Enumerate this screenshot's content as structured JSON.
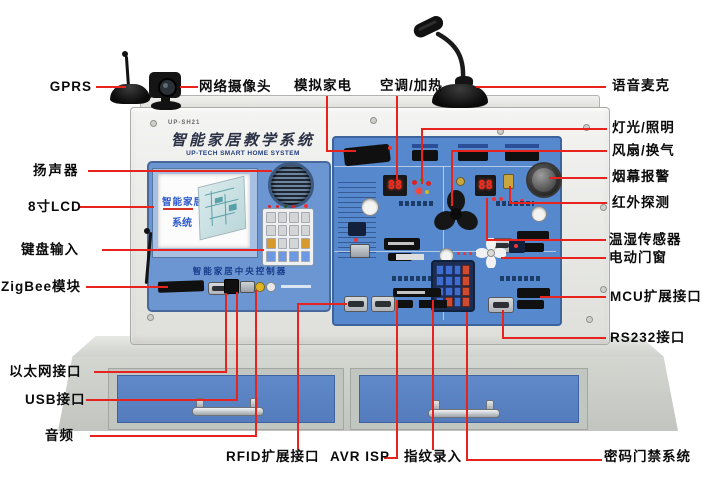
{
  "device": {
    "model": "UP-SH21",
    "title": "智能家居教学系统",
    "subtitle": "UP-TECH SMART HOME SYSTEM",
    "lcd_line1": "智能家居",
    "lcd_line2": "系统",
    "panel_caption": "智能家居中央控制器",
    "display_ac": "88",
    "display_temp": "88"
  },
  "colors": {
    "callout_red": "#e8231d",
    "panel_blue": "#5688cd",
    "drawer_blue": "#5c83c5"
  },
  "callouts": {
    "gprs": {
      "label": "GPRS"
    },
    "camera": {
      "label": "网络摄像头"
    },
    "speaker": {
      "label": "扬声器"
    },
    "lcd8": {
      "label": "8寸LCD"
    },
    "keypad": {
      "label": "键盘输入"
    },
    "zigbee": {
      "label": "ZigBee模块"
    },
    "ethernet": {
      "label": "以太网接口"
    },
    "usb": {
      "label": "USB接口"
    },
    "audio": {
      "label": "音频"
    },
    "sim_appliance": {
      "label": "模拟家电"
    },
    "ac_heat": {
      "label": "空调/加热"
    },
    "voice_mic": {
      "label": "语音麦克"
    },
    "light": {
      "label": "灯光/照明"
    },
    "fan_vent": {
      "label": "风扇/换气"
    },
    "smoke_alarm": {
      "label": "烟幕报警"
    },
    "ir_detect": {
      "label": "红外探测"
    },
    "temp_humidity": {
      "label": "温湿传感器"
    },
    "motor_window": {
      "label": "电动门窗"
    },
    "mcu_ext": {
      "label": "MCU扩展接口"
    },
    "rs232": {
      "label": "RS232接口"
    },
    "rfid_ext": {
      "label": "RFID扩展接口"
    },
    "avr_isp": {
      "label": "AVR ISP"
    },
    "fingerprint": {
      "label": "指纹录入"
    },
    "door_access": {
      "label": "密码门禁系统"
    }
  }
}
